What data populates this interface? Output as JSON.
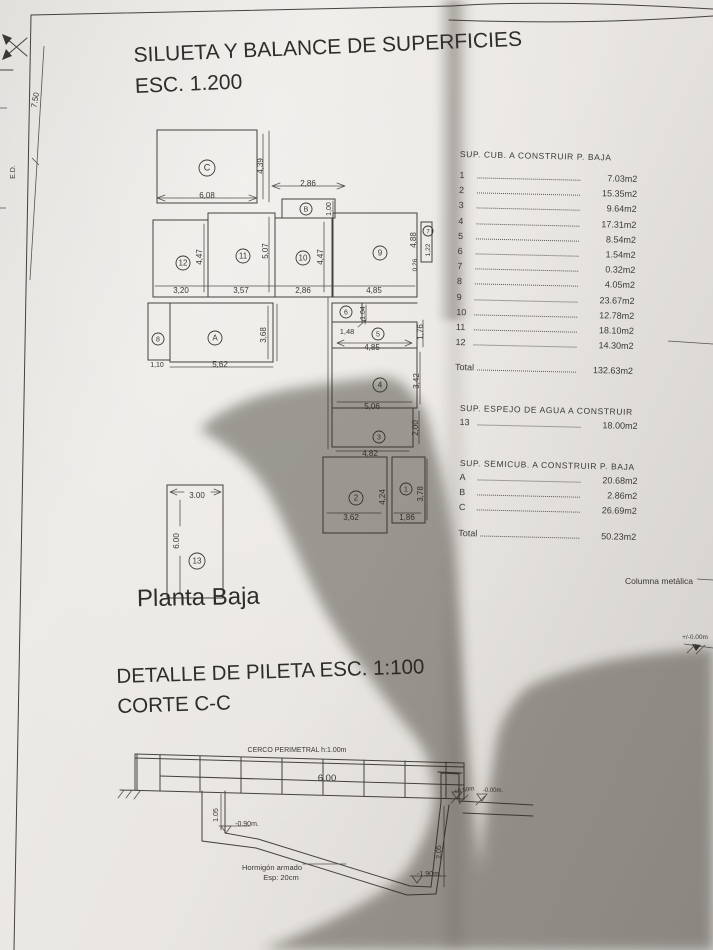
{
  "title": {
    "line1": "SILUETA Y BALANCE DE SUPERFICIES",
    "line2": "ESC. 1.200"
  },
  "plan_label": "Planta Baja",
  "detail_title": {
    "line1": "DETALLE DE PILETA ESC. 1:100",
    "line2": "CORTE C-C"
  },
  "tables": {
    "cub": {
      "header": "SUP. CUB. A CONSTRUIR P. BAJA",
      "rows": [
        [
          "1",
          "7.03m2"
        ],
        [
          "2",
          "15.35m2"
        ],
        [
          "3",
          "9.64m2"
        ],
        [
          "4",
          "17.31m2"
        ],
        [
          "5",
          "8.54m2"
        ],
        [
          "6",
          "1.54m2"
        ],
        [
          "7",
          "0.32m2"
        ],
        [
          "8",
          "4.05m2"
        ],
        [
          "9",
          "23.67m2"
        ],
        [
          "10",
          "12.78m2"
        ],
        [
          "11",
          "18.10m2"
        ],
        [
          "12",
          "14.30m2"
        ]
      ],
      "total": [
        "Total",
        "132.63m2"
      ]
    },
    "espejo": {
      "header": "SUP. ESPEJO DE AGUA A CONSTRUIR",
      "rows": [
        [
          "13",
          "18.00m2"
        ]
      ]
    },
    "semicub": {
      "header": "SUP. SEMICUB. A CONSTRUIR P. BAJA",
      "rows": [
        [
          "A",
          "20.68m2"
        ],
        [
          "B",
          "2.86m2"
        ],
        [
          "C",
          "26.69m2"
        ]
      ],
      "total": [
        "Total",
        "50.23m2"
      ]
    }
  },
  "plan_texts": [
    {
      "t": "C",
      "x": 207,
      "y": 168,
      "s": 9,
      "c": 8
    },
    {
      "t": "6,08",
      "x": 207,
      "y": 195,
      "s": 8
    },
    {
      "t": "4,39",
      "x": 260,
      "y": 166,
      "s": 8,
      "r": -90
    },
    {
      "t": "2,86",
      "x": 308,
      "y": 183,
      "s": 8
    },
    {
      "t": "B",
      "x": 306,
      "y": 209,
      "s": 7,
      "c": 6
    },
    {
      "t": "1,00",
      "x": 328,
      "y": 209,
      "s": 7,
      "r": -90
    },
    {
      "t": "12",
      "x": 183,
      "y": 263,
      "s": 8,
      "c": 7
    },
    {
      "t": "11",
      "x": 243,
      "y": 256,
      "s": 8,
      "c": 7
    },
    {
      "t": "10",
      "x": 303,
      "y": 258,
      "s": 8,
      "c": 7
    },
    {
      "t": "9",
      "x": 380,
      "y": 253,
      "s": 8,
      "c": 7
    },
    {
      "t": "7",
      "x": 428,
      "y": 231,
      "s": 6,
      "c": 5
    },
    {
      "t": "3,20",
      "x": 181,
      "y": 290,
      "s": 8
    },
    {
      "t": "3,57",
      "x": 241,
      "y": 290,
      "s": 8
    },
    {
      "t": "2,86",
      "x": 303,
      "y": 290,
      "s": 8
    },
    {
      "t": "4,85",
      "x": 374,
      "y": 290,
      "s": 8
    },
    {
      "t": "4,47",
      "x": 199,
      "y": 257,
      "s": 8,
      "r": -90
    },
    {
      "t": "5,07",
      "x": 265,
      "y": 251,
      "s": 8,
      "r": -90
    },
    {
      "t": "4,47",
      "x": 320,
      "y": 257,
      "s": 8,
      "r": -90
    },
    {
      "t": "4,88",
      "x": 413,
      "y": 240,
      "s": 8,
      "r": -90
    },
    {
      "t": "1,22",
      "x": 427,
      "y": 250,
      "s": 6.5,
      "r": -90
    },
    {
      "t": "0,26",
      "x": 414,
      "y": 265,
      "s": 6.5,
      "r": -90
    },
    {
      "t": "8",
      "x": 158,
      "y": 339,
      "s": 7,
      "c": 6
    },
    {
      "t": "A",
      "x": 215,
      "y": 338,
      "s": 8,
      "c": 7
    },
    {
      "t": "1,10",
      "x": 157,
      "y": 364,
      "s": 7
    },
    {
      "t": "5,62",
      "x": 220,
      "y": 364,
      "s": 8
    },
    {
      "t": "3,68",
      "x": 263,
      "y": 335,
      "s": 8,
      "r": -90
    },
    {
      "t": "6",
      "x": 346,
      "y": 312,
      "s": 7,
      "c": 6
    },
    {
      "t": "1,48",
      "x": 347,
      "y": 331,
      "s": 7.5
    },
    {
      "t": "1.04",
      "x": 362,
      "y": 313,
      "s": 7,
      "r": -90
    },
    {
      "t": "5",
      "x": 378,
      "y": 334,
      "s": 7,
      "c": 6
    },
    {
      "t": "4,85",
      "x": 372,
      "y": 347,
      "s": 8
    },
    {
      "t": "1,76",
      "x": 420,
      "y": 332,
      "s": 8,
      "r": -90
    },
    {
      "t": "4",
      "x": 380,
      "y": 385,
      "s": 8,
      "c": 7
    },
    {
      "t": "5,06",
      "x": 372,
      "y": 406,
      "s": 8
    },
    {
      "t": "3,42",
      "x": 416,
      "y": 381,
      "s": 8,
      "r": -90
    },
    {
      "t": "3",
      "x": 379,
      "y": 437,
      "s": 7,
      "c": 6
    },
    {
      "t": "4,82",
      "x": 370,
      "y": 453,
      "s": 8
    },
    {
      "t": "2,00",
      "x": 415,
      "y": 428,
      "s": 8,
      "r": -90
    },
    {
      "t": "2",
      "x": 356,
      "y": 498,
      "s": 8,
      "c": 7
    },
    {
      "t": "3,62",
      "x": 351,
      "y": 517,
      "s": 8
    },
    {
      "t": "4,24",
      "x": 382,
      "y": 497,
      "s": 8,
      "r": -90
    },
    {
      "t": "1",
      "x": 406,
      "y": 489,
      "s": 7,
      "c": 6
    },
    {
      "t": "1,86",
      "x": 407,
      "y": 517,
      "s": 8
    },
    {
      "t": "3,78",
      "x": 420,
      "y": 494,
      "s": 8,
      "r": -90
    },
    {
      "t": "3.00",
      "x": 197,
      "y": 495,
      "s": 8
    },
    {
      "t": "6.00",
      "x": 176,
      "y": 541,
      "s": 8,
      "r": -90
    },
    {
      "t": "13",
      "x": 197,
      "y": 561,
      "s": 8,
      "c": 8
    },
    {
      "t": "7.50",
      "x": 35,
      "y": 100,
      "s": 8,
      "r": -80
    },
    {
      "t": "E.D.",
      "x": 12,
      "y": 172,
      "s": 7,
      "r": -90
    }
  ],
  "pool_texts": [
    {
      "t": "CERCO PERIMETRAL h:1.00m",
      "x": 297,
      "y": 749,
      "s": 7
    },
    {
      "t": "6.00",
      "x": 327,
      "y": 778,
      "s": 9.5
    },
    {
      "t": "1.05",
      "x": 215,
      "y": 815,
      "s": 7,
      "r": -90
    },
    {
      "t": "-0.90m.",
      "x": 247,
      "y": 823,
      "s": 7
    },
    {
      "t": "2.05",
      "x": 438,
      "y": 852,
      "s": 7,
      "r": -90
    },
    {
      "t": "-1.90m.",
      "x": 429,
      "y": 873,
      "s": 7
    },
    {
      "t": "+0.50m",
      "x": 464,
      "y": 789,
      "s": 6,
      "r": -10
    },
    {
      "t": "-0.00m.",
      "x": 493,
      "y": 789,
      "s": 6
    },
    {
      "t": "Hormigón armado",
      "x": 272,
      "y": 867,
      "s": 7.5
    },
    {
      "t": "Esp: 20cm",
      "x": 281,
      "y": 877,
      "s": 7.5
    }
  ],
  "annot_texts": [
    {
      "t": "Columna metálica",
      "x": 659,
      "y": 581,
      "s": 8.5
    },
    {
      "t": "+/-0.00m",
      "x": 695,
      "y": 636,
      "s": 6.5
    }
  ],
  "colors": {
    "ink": "#45423d",
    "paper": "#e9e7e3",
    "shadow": "#2b251f"
  }
}
